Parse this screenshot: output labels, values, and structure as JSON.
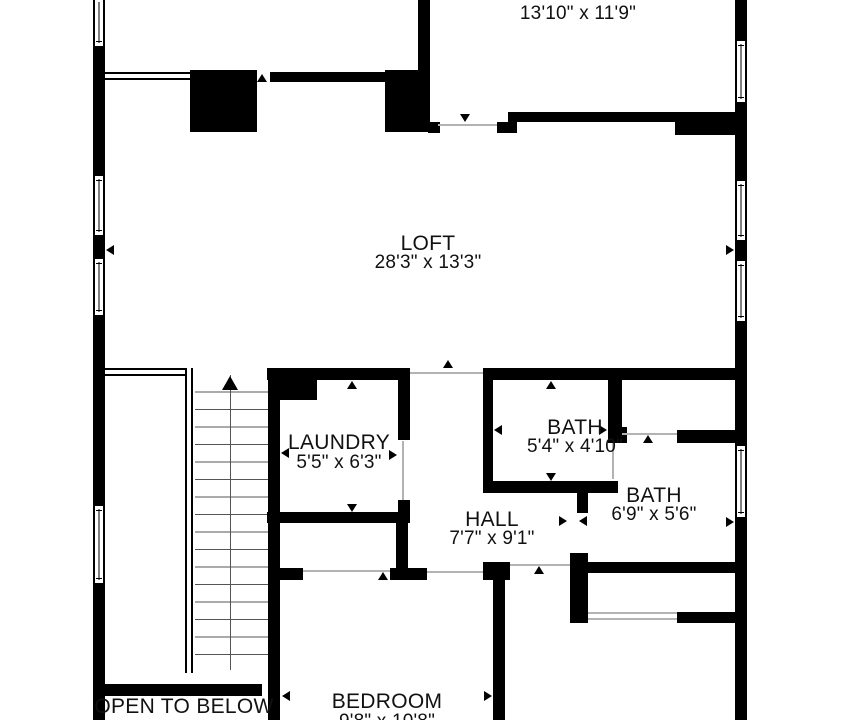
{
  "rooms": {
    "primary_bedroom": {
      "name": "PRIMARY BEDROOM",
      "dims": "13'10\" x 11'9\""
    },
    "loft": {
      "name": "LOFT",
      "dims": "28'3\" x 13'3\""
    },
    "laundry": {
      "name": "LAUNDRY",
      "dims": "5'5\" x 6'3\""
    },
    "bath_small": {
      "name": "BATH",
      "dims": "5'4\" x 4'10\""
    },
    "bath_large": {
      "name": "BATH",
      "dims": "6'9\" x 5'6\""
    },
    "hall": {
      "name": "HALL",
      "dims": "7'7\" x 9'1\""
    },
    "bedroom": {
      "name": "BEDROOM",
      "dims": "9'8\" x 10'8\""
    },
    "open_to_below": {
      "name": "OPEN TO BELOW"
    }
  },
  "colors": {
    "wall": "#000000",
    "background": "#ffffff",
    "door_line": "#b3b3b3",
    "text": "#111111"
  }
}
